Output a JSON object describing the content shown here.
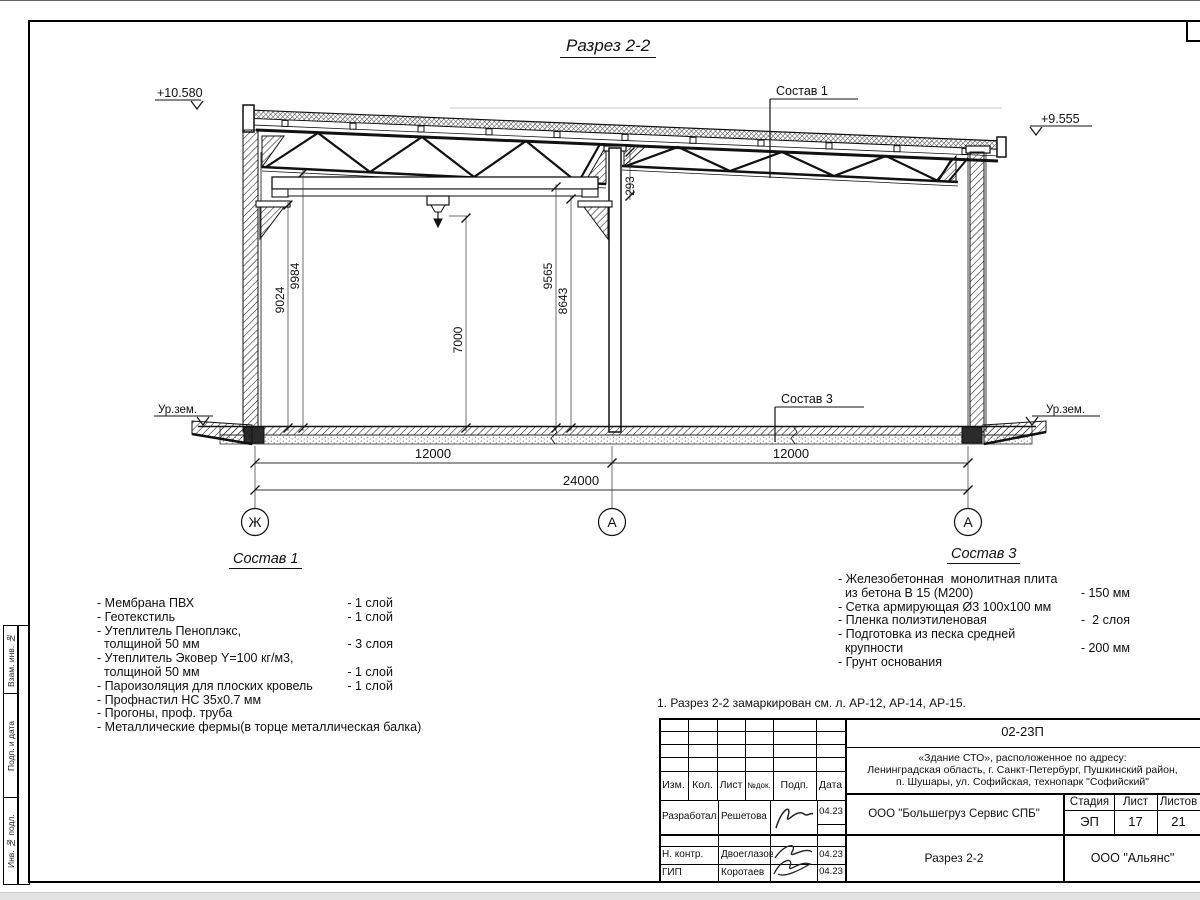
{
  "page": {
    "title": "Разрез 2-2"
  },
  "drawing": {
    "elevation_left": "+10.580",
    "elevation_right": "+9.555",
    "leader_sostav1": "Состав 1",
    "leader_sostav3": "Состав 3",
    "ground_label_left": "Ур.зем.",
    "ground_label_right": "Ур.зем.",
    "dims": {
      "h_9024": "9024",
      "h_9984": "9984",
      "h_7000": "7000",
      "h_9565": "9565",
      "h_8643": "8643",
      "step_293": "293",
      "bay_left": "12000",
      "bay_right": "12000",
      "total": "24000"
    },
    "axes": {
      "left": "Ж",
      "mid": "А",
      "right": "А"
    }
  },
  "sostav1": {
    "heading": "Состав 1",
    "rows": [
      {
        "text": "- Мембрана ПВХ",
        "qty": "- 1 слой"
      },
      {
        "text": "- Геотекстиль",
        "qty": "- 1 слой"
      },
      {
        "text": "- Утеплитель Пеноплэкс,",
        "qty": ""
      },
      {
        "text": "  толщиной 50 мм",
        "qty": "- 3 слоя"
      },
      {
        "text": "- Утеплитель Эковер Y=100 кг/м3,",
        "qty": ""
      },
      {
        "text": "  толщиной 50 мм",
        "qty": "- 1 слой"
      },
      {
        "text": "- Пароизоляция для плоских кровель",
        "qty": "- 1 слой"
      },
      {
        "text": "- Профнастил НС 35х0.7 мм",
        "qty": ""
      },
      {
        "text": "- Прогоны, проф. труба",
        "qty": ""
      },
      {
        "text": "- Металлические фермы(в торце металлическая балка)",
        "qty": ""
      }
    ]
  },
  "sostav3": {
    "heading": "Состав 3",
    "rows": [
      {
        "text": "- Железобетонная  монолитная плита",
        "qty": ""
      },
      {
        "text": "  из бетона В 15 (М200)",
        "qty": "- 150 мм"
      },
      {
        "text": "- Сетка армирующая Ø3 100х100 мм",
        "qty": ""
      },
      {
        "text": "- Пленка полиэтиленовая",
        "qty": "-  2 слоя"
      },
      {
        "text": "- Подготовка из песка средней",
        "qty": ""
      },
      {
        "text": "  крупности",
        "qty": "- 200 мм"
      },
      {
        "text": "- Грунт основания",
        "qty": ""
      }
    ]
  },
  "note": "1. Разрез 2-2 замаркирован см. л. АР-12, АР-14, АР-15.",
  "stamp": {
    "code": "02-23П",
    "address_line1": "«Здание СТО», расположенное по адресу:",
    "address_line2": "Ленинградская область, г. Санкт-Петербург, Пушкинский район,",
    "address_line3": "п. Шушары, ул. Софийская, технопарк \"Софийский\"",
    "cols": {
      "izm": "Изм.",
      "kol": "Кол.",
      "list": "Лист",
      "ndok": "№док.",
      "podp": "Подп.",
      "data": "Дата"
    },
    "sig_rows": [
      {
        "role": "Разработал",
        "name": "Решетова",
        "date": "04.23"
      },
      {
        "role": "Н. контр.",
        "name": "Двоеглазов",
        "date": "04.23"
      },
      {
        "role": "ГИП",
        "name": "Коротаев",
        "date": "04.23"
      }
    ],
    "org": "ООО \"Большегруз Сервис СПБ\"",
    "sheet_title": "Разрез 2-2",
    "company": "ООО \"Альянс\"",
    "stage_label": "Стадия",
    "sheet_label": "Лист",
    "sheets_label": "Листов",
    "stage": "ЭП",
    "sheet": "17",
    "sheets": "21"
  },
  "side_labels": {
    "vzam": "Взам. инв. №",
    "podp": "Подп. и дата",
    "inv": "Инв. № подл."
  }
}
